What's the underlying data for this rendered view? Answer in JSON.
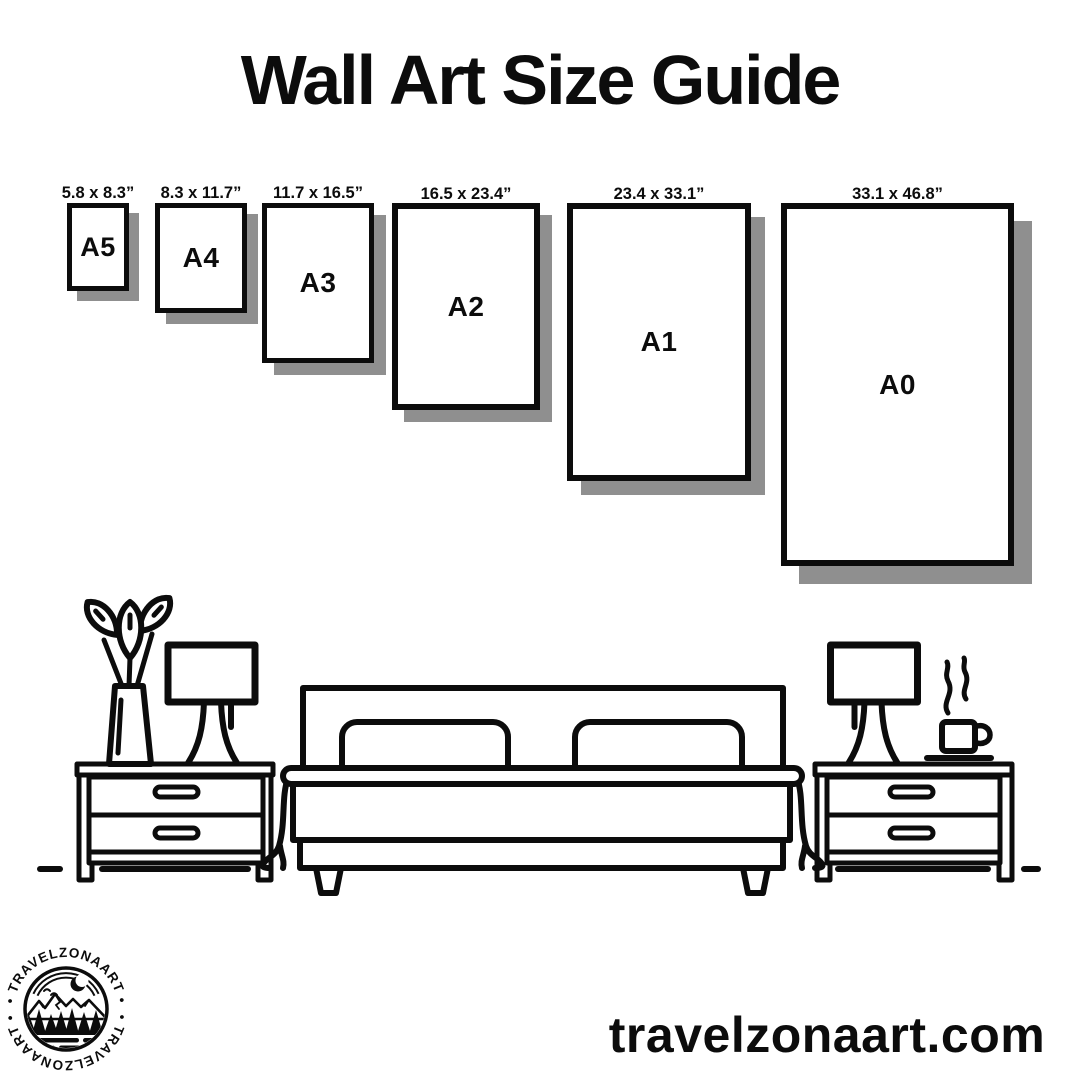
{
  "title": "Wall Art Size Guide",
  "sizes": [
    {
      "name": "A5",
      "dimensions": "5.8 x 8.3”"
    },
    {
      "name": "A4",
      "dimensions": "8.3 x 11.7”"
    },
    {
      "name": "A3",
      "dimensions": "11.7 x 16.5”"
    },
    {
      "name": "A2",
      "dimensions": "16.5 x 23.4”"
    },
    {
      "name": "A1",
      "dimensions": "23.4 x 33.1”"
    },
    {
      "name": "A0",
      "dimensions": "33.1 x 46.8”"
    }
  ],
  "logo": {
    "arc_text": "• TRAVELZONAART •"
  },
  "website": "travelzonaart.com",
  "scene": {
    "items": [
      "flower-vase",
      "table-lamp",
      "nightstand",
      "double-bed",
      "nightstand",
      "table-lamp",
      "coffee-cup"
    ]
  },
  "colors": {
    "ink": "#0c0c0c",
    "shadow": "#8f8f8f",
    "background": "#ffffff"
  }
}
